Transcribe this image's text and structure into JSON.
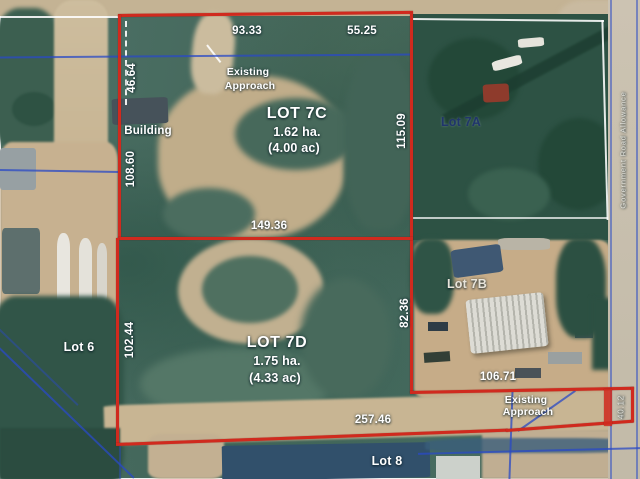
{
  "map": {
    "type": "aerial-parcel-plan",
    "lots": {
      "lot7c_name": "LOT 7C",
      "lot7c_ha": "1.62 ha.",
      "lot7c_ac": "(4.00 ac)",
      "lot7d_name": "LOT 7D",
      "lot7d_ha": "1.75 ha.",
      "lot7d_ac": "(4.33 ac)",
      "lot7a": "Lot 7A",
      "lot7b": "Lot 7B",
      "lot6": "Lot 6",
      "lot8": "Lot 8"
    },
    "labels": {
      "building": "Building",
      "approach_line1": "Existing",
      "approach_line2": "Approach",
      "road_allowance": "Government Road Allowance"
    },
    "measurements": {
      "north_west": "93.33",
      "north_east": "55.25",
      "west_north": "46.64",
      "west_building": "108.60",
      "east_7c": "115.09",
      "divider": "149.36",
      "west_7d": "102.44",
      "east_7d": "82.36",
      "south_east": "106.71",
      "south_7d": "257.46",
      "east_edge": "40.12"
    },
    "colors": {
      "boundary_red": "#d02a1e",
      "survey_blue": "#2a4ac6",
      "label_white": "#ffffff",
      "lot7a_text_navy": "#20356b",
      "terrain_green": "#46685b",
      "cleared_tan": "#c2b090"
    }
  }
}
